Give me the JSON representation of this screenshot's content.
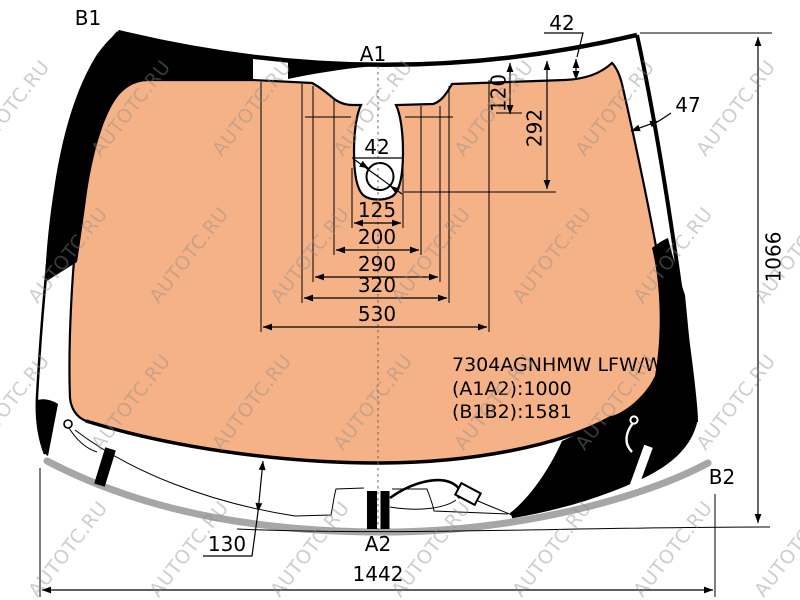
{
  "watermark": {
    "text": "AUTOTC.RU"
  },
  "labels": {
    "b1": "B1",
    "a1": "A1",
    "a2": "A2",
    "b2": "B2"
  },
  "dimensions": {
    "top_edge_to_band": "42",
    "band_width_side": "47",
    "sensor_recess_depth": "120",
    "sensor_total_depth": "292",
    "sensor_hole_diameter": "42",
    "sensor_width_1": "125",
    "sensor_width_2": "200",
    "sensor_width_3": "290",
    "sensor_width_4": "320",
    "sensor_width_5": "530",
    "height_right": "1066",
    "bottom_edge_to_cowl": "130",
    "width_bottom": "1442"
  },
  "part_info": {
    "part_number": "7304AGNHMW LFW/W/X",
    "diagonal_a": "(A1A2):1000",
    "diagonal_b": "(B1B2):1581"
  },
  "colors": {
    "glass_tint": "#F5B287",
    "frit_band": "#000000",
    "moulding": "#A6A6A6"
  }
}
